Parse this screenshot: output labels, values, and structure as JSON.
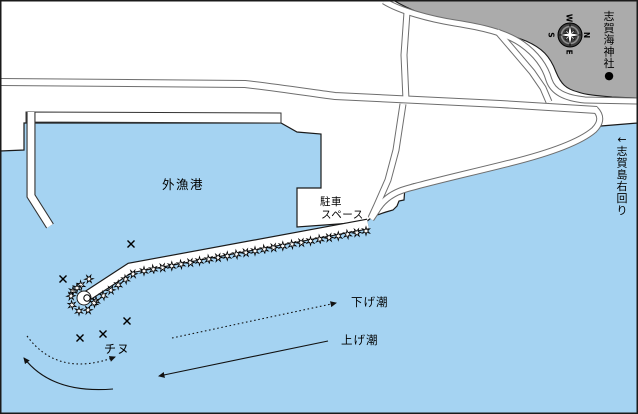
{
  "map": {
    "description_labels": {
      "harbor": "外漁港",
      "parking_line1": "駐車",
      "parking_line2": "スペース",
      "ebb_tide": "下げ潮",
      "flood_tide": "上げ潮",
      "fish_spot": "チヌ",
      "shrine": "志賀海神社●",
      "island_route": "←志賀島右回り"
    },
    "labels": [
      {
        "id": "harbor-label",
        "text": "外漁港",
        "x": 183,
        "y": 189,
        "size": 12.5,
        "anchor": "middle",
        "spacing": 1.5
      },
      {
        "id": "parking-label-line1",
        "text": "駐車",
        "x": 320,
        "y": 205,
        "size": 10.5,
        "anchor": "start",
        "spacing": 0.5
      },
      {
        "id": "parking-label-line2",
        "text": "スペース",
        "x": 321,
        "y": 218,
        "size": 10.5,
        "anchor": "start",
        "spacing": 0.5
      },
      {
        "id": "ebb-tide-label",
        "text": "下げ潮",
        "x": 351,
        "y": 306,
        "size": 11.5,
        "anchor": "start",
        "spacing": 1
      },
      {
        "id": "flood-tide-label",
        "text": "上げ潮",
        "x": 341,
        "y": 344,
        "size": 11.5,
        "anchor": "start",
        "spacing": 1
      },
      {
        "id": "chinu-label",
        "text": "チヌ",
        "x": 104,
        "y": 353,
        "size": 12,
        "anchor": "start",
        "spacing": 1
      },
      {
        "id": "shrine-label",
        "text": "志賀海神社●",
        "x": 609,
        "y": 9,
        "size": 11,
        "vertical": true
      },
      {
        "id": "island-route-label",
        "text": "←志賀島右回り",
        "x": 622,
        "y": 132,
        "size": 11,
        "vertical": true
      }
    ],
    "fishing_spots": [
      [
        131,
        244
      ],
      [
        63,
        279
      ],
      [
        127,
        321
      ],
      [
        103,
        334
      ],
      [
        80,
        338
      ]
    ],
    "tide_arrows": [
      {
        "id": "ebb-tide-arrow-straight",
        "style": "dotted",
        "path": "M172,338 L336,303"
      },
      {
        "id": "ebb-tide-arrow-curved",
        "style": "dotted",
        "path": "M27,336 Q58,378 115,357"
      },
      {
        "id": "flood-tide-arrow-straight",
        "style": "solid",
        "path": "M328,341 L159,376"
      },
      {
        "id": "flood-tide-arrow-curved",
        "style": "solid",
        "path": "M113,389 Q52,394 24,358"
      }
    ],
    "compass": {
      "n": "N",
      "e": "E",
      "s": "S",
      "w": "W",
      "rotation_deg": 90,
      "cx": 570,
      "cy": 35
    },
    "tetrapod_rows": [
      {
        "x1": 366,
        "y1": 231,
        "x2": 144,
        "y2": 271,
        "n": 25
      },
      {
        "x1": 133,
        "y1": 274,
        "x2": 96,
        "y2": 301,
        "n": 6
      },
      {
        "x1": 89,
        "y1": 279,
        "x2": 73,
        "y2": 291,
        "n": 3
      }
    ],
    "tetrapod_cluster": [
      [
        71,
        296
      ],
      [
        72,
        305
      ],
      [
        79,
        311
      ],
      [
        88,
        310
      ],
      [
        94,
        303
      ],
      [
        77,
        288
      ]
    ],
    "beacon": {
      "x": 87,
      "y": 298
    },
    "colors": {
      "sea": "#A5D3F2",
      "land": "#FFFFFF",
      "hill": "#ABABAB",
      "outline": "#1A1A1A",
      "road_casing": "#6E6E6E",
      "road_fill": "#FFFFFF",
      "structure_outline": "#333333",
      "structure_fill": "#FFFFFF",
      "compass_disc": "#3F3F3F",
      "text": "#000000"
    }
  }
}
